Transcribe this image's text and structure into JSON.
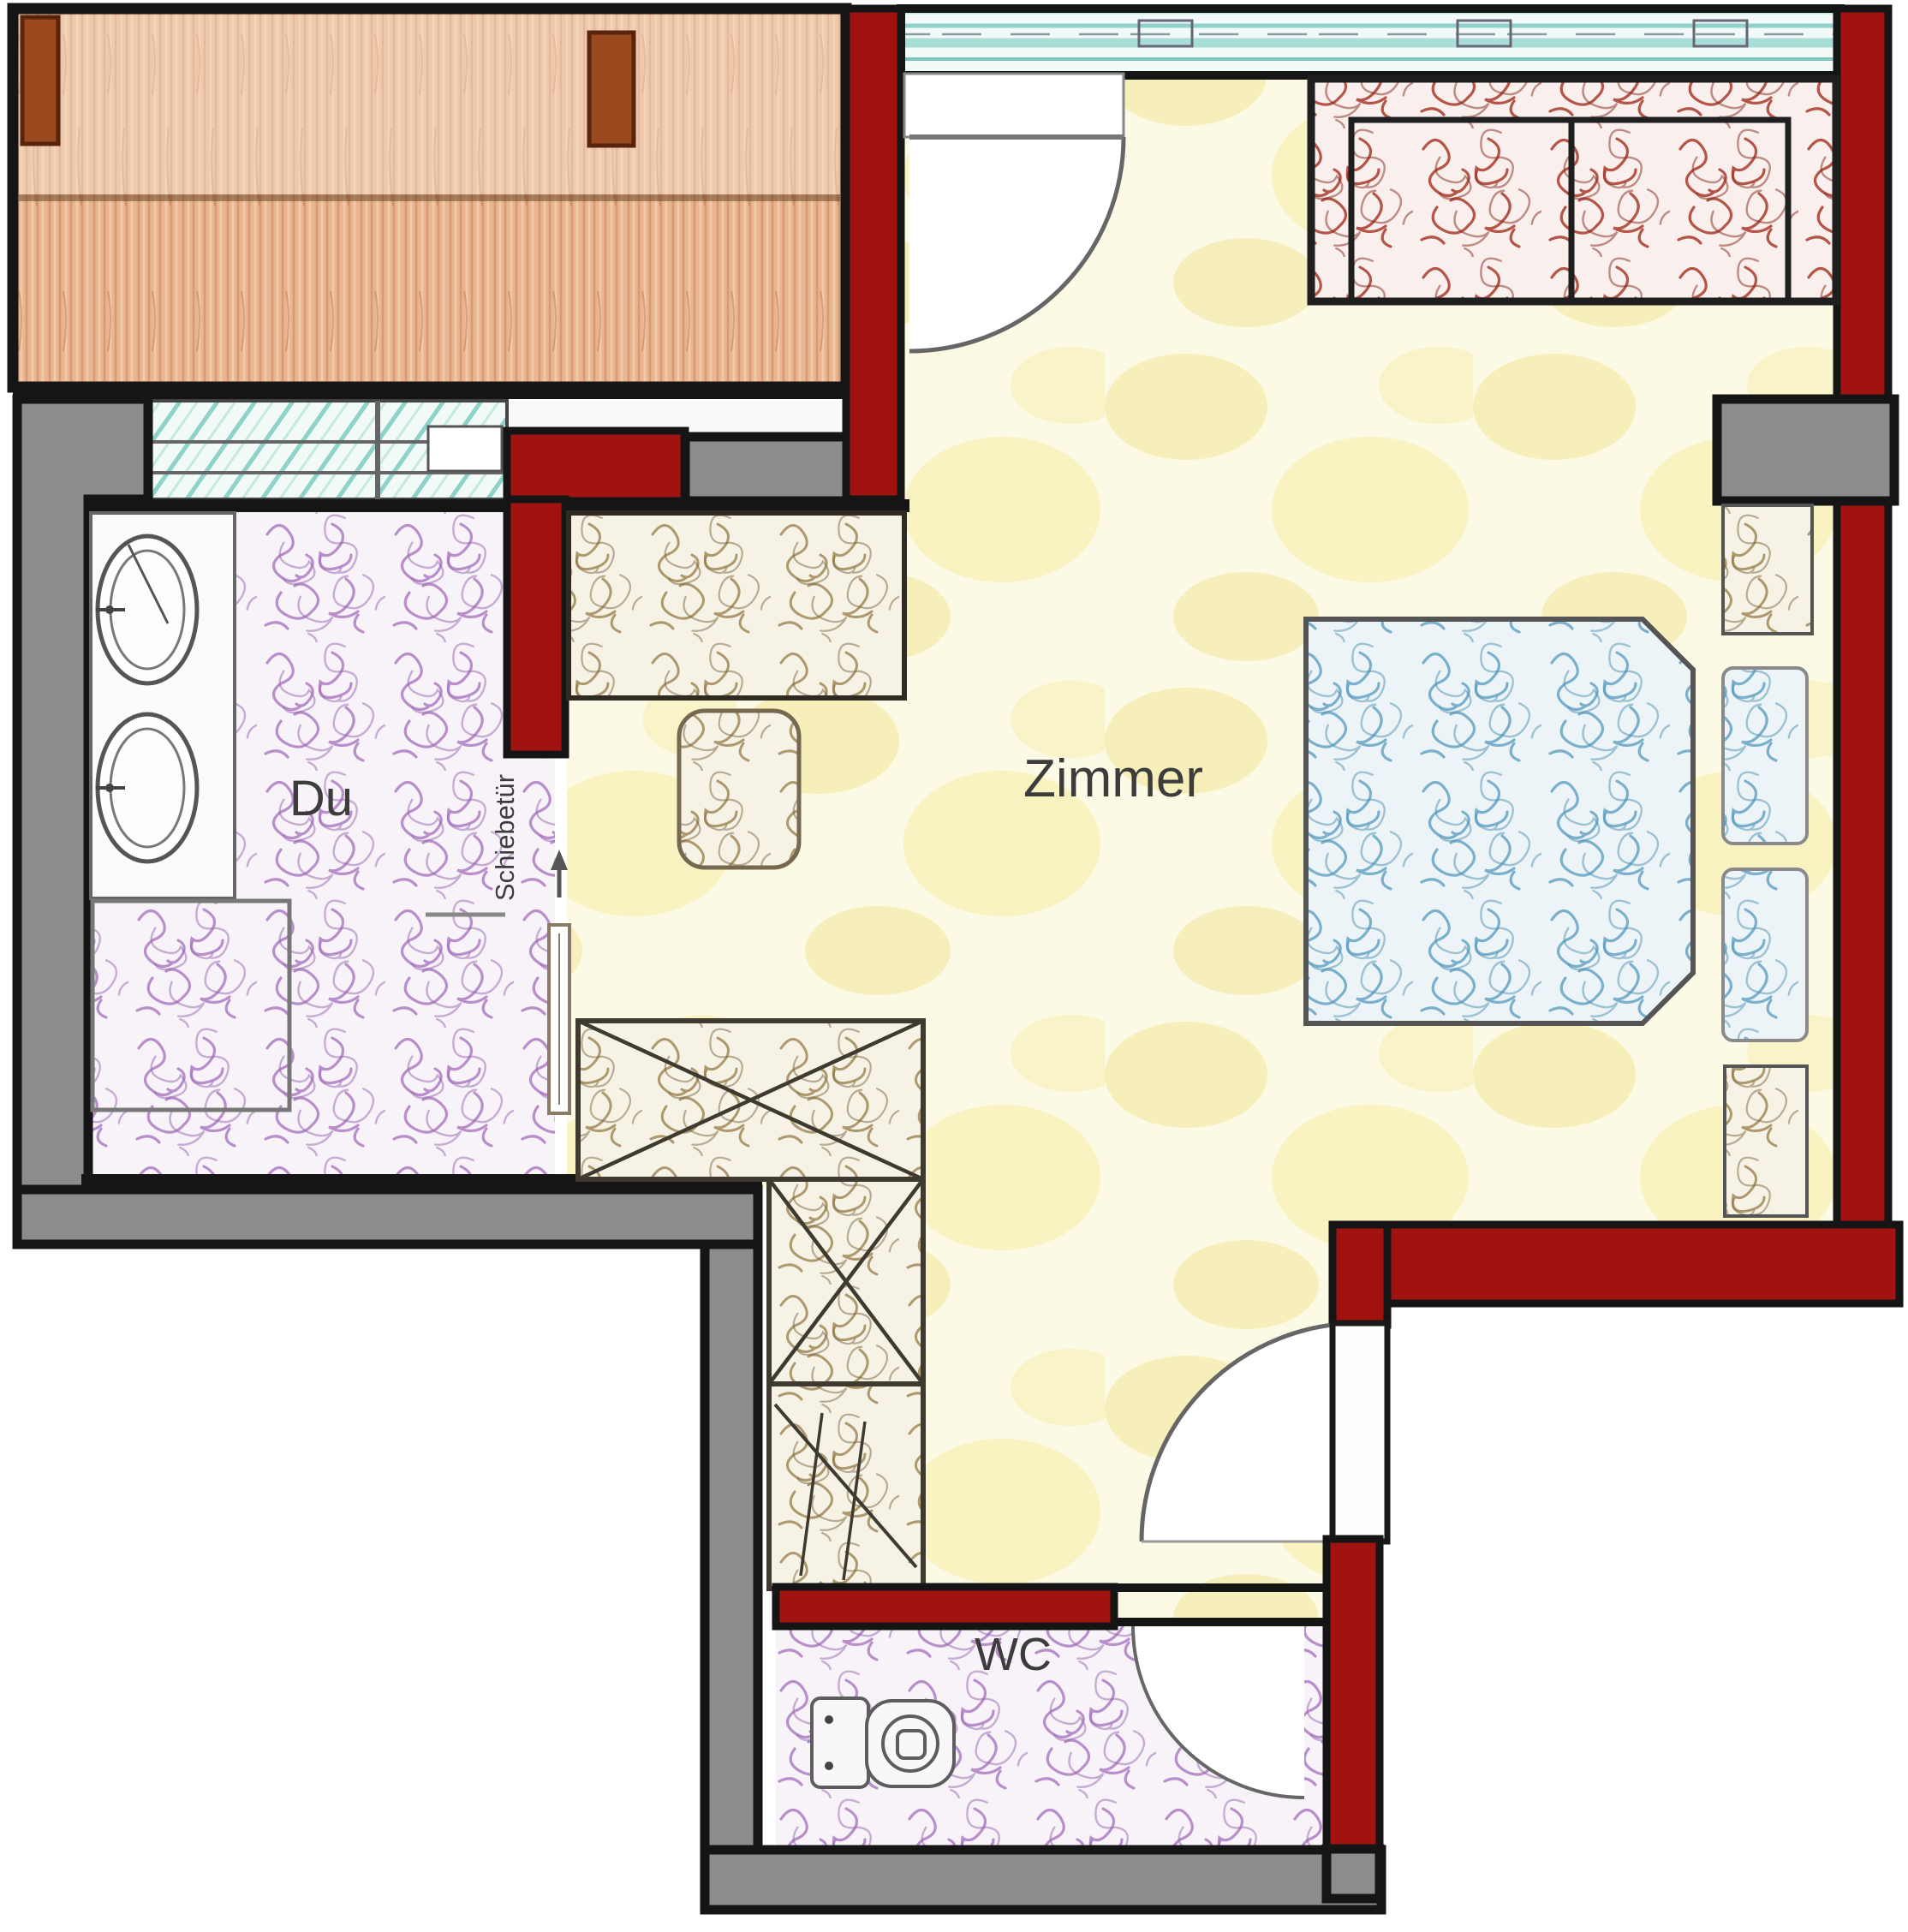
{
  "floorplan": {
    "labels": {
      "room": "Zimmer",
      "shower": "Du",
      "wc": "WC",
      "sliding_door": "Schiebetür"
    },
    "colors": {
      "outline": "#151515",
      "wall_red": "#a01310",
      "wall_gray": "#8c8c8c",
      "door_line": "#666666",
      "label_text": "#3c3c3c",
      "floor_yellow": "#fcf9e4",
      "floor_blotch": "#f2e795",
      "wood_deck": "#e9b58f",
      "wood_post": "#9a481e",
      "window_teal": "#8fd2c9",
      "scribble_purple": "#b184c6",
      "scribble_blue": "#6ea9c8",
      "scribble_red": "#a8392b",
      "scribble_tan": "#a08a58"
    },
    "icons": [
      "balcony-deck",
      "balcony-post-icon",
      "window-band-icon",
      "door-swing-icon",
      "sofa-icon",
      "double-bed-icon",
      "pillow-icon",
      "nightstand-icon",
      "wardrobe-icon",
      "desk-icon",
      "chair-icon",
      "washbasin-icon",
      "shower-tray-icon",
      "sliding-door-icon",
      "arrow-up-icon",
      "toilet-icon"
    ]
  }
}
